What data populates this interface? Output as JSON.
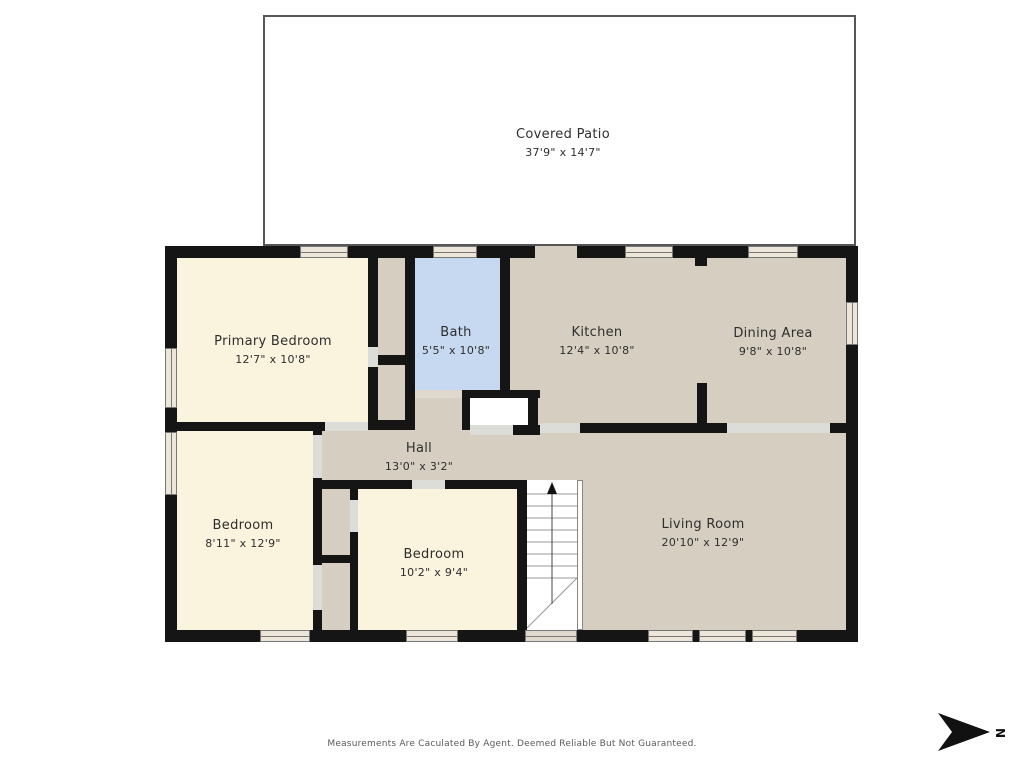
{
  "rooms": [
    {
      "id": "covered-patio",
      "name": "Covered Patio",
      "dims": "37'9\" x 14'7\""
    },
    {
      "id": "primary-bedroom",
      "name": "Primary Bedroom",
      "dims": "12'7\" x 10'8\""
    },
    {
      "id": "bath",
      "name": "Bath",
      "dims": "5'5\" x 10'8\""
    },
    {
      "id": "kitchen",
      "name": "Kitchen",
      "dims": "12'4\" x 10'8\""
    },
    {
      "id": "dining-area",
      "name": "Dining Area",
      "dims": "9'8\" x 10'8\""
    },
    {
      "id": "hall",
      "name": "Hall",
      "dims": "13'0\" x 3'2\""
    },
    {
      "id": "bedroom-left",
      "name": "Bedroom",
      "dims": "8'11\" x 12'9\""
    },
    {
      "id": "bedroom-middle",
      "name": "Bedroom",
      "dims": "10'2\" x 9'4\""
    },
    {
      "id": "living-room",
      "name": "Living Room",
      "dims": "20'10\" x 12'9\""
    }
  ],
  "footer": {
    "disclaimer": "Measurements Are Caculated By Agent. Deemed Reliable But Not Guaranteed."
  },
  "compass": {
    "label": "N"
  },
  "colors": {
    "wall": "#151515",
    "taupe": "#d6cfc1",
    "cream": "#faf3dd",
    "bath": "#c7d9f1",
    "doorgap": "#dcdcd8",
    "doortan": "#ded9cc",
    "winfill": "#ece6d8",
    "patioborder": "#565656"
  }
}
